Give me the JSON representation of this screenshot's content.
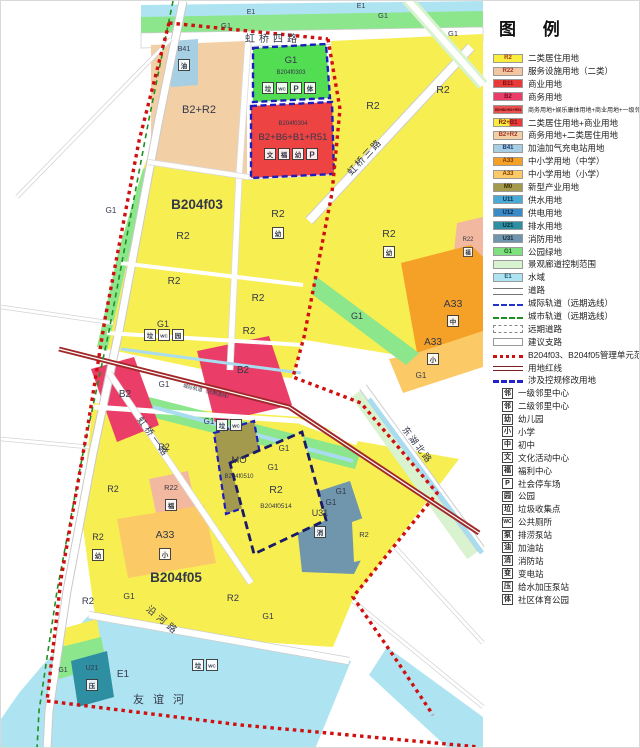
{
  "legend": {
    "title": "图  例",
    "swatches": [
      {
        "code": "R2",
        "label": "二类居住用地",
        "color": "#f9ee3e",
        "tc": "#a33325"
      },
      {
        "code": "R22",
        "label": "服务设施用地（二类）",
        "color": "#f3c6a2",
        "tc": "#a33325"
      },
      {
        "code": "B11",
        "label": "商业用地",
        "color": "#e93a3a",
        "tc": "#7a0f0f"
      },
      {
        "code": "B2",
        "label": "商务用地",
        "color": "#ea3e68",
        "tc": "#6e0f2a"
      },
      {
        "code": "B2+B6+B1+R51",
        "label": "商务用地+娱乐康体用地+商业用地+一级邻里中心用地",
        "color": "#e95050",
        "tc": "#5e0a0a",
        "small": true,
        "small_label": true
      },
      {
        "code": "R2+B1",
        "label": "二类居住用地+商业用地",
        "color": "#f9ee3e",
        "color2": "#e93a3a",
        "tc": "#7a0f0f"
      },
      {
        "code": "B2+R2",
        "label": "商务用地+二类居住用地",
        "color": "#f3cfa6",
        "tc": "#a33325"
      },
      {
        "code": "B41",
        "label": "加油加气充电站用地",
        "color": "#a6cfe3",
        "tc": "#1a3a74"
      },
      {
        "code": "A33",
        "label": "中小学用地（中学）",
        "color": "#f5a027",
        "tc": "#7a3a00"
      },
      {
        "code": "A33",
        "label": "中小学用地（小学）",
        "color": "#fbc966",
        "tc": "#7a3a00"
      },
      {
        "code": "M0",
        "label": "新型产业用地",
        "color": "#a39a4e",
        "tc": "#3a3000"
      },
      {
        "code": "U11",
        "label": "供水用地",
        "color": "#4aaad6",
        "tc": "#0a2a4a"
      },
      {
        "code": "U12",
        "label": "供电用地",
        "color": "#3a8ac8",
        "tc": "#0a2a4a"
      },
      {
        "code": "U21",
        "label": "排水用地",
        "color": "#2e8fa3",
        "tc": "#062c38"
      },
      {
        "code": "U31",
        "label": "消防用地",
        "color": "#7096ad",
        "tc": "#14283a"
      },
      {
        "code": "G1",
        "label": "公园绿地",
        "color": "#7ee07e",
        "tc": "#14591c"
      },
      {
        "code": "",
        "label": "景观廊道控制范围",
        "color": "#d9f2cf",
        "tc": "#333"
      },
      {
        "code": "E1",
        "label": "水域",
        "color": "#aee4f2",
        "tc": "#1c5a74"
      }
    ],
    "lines": [
      {
        "style": "road",
        "label": "道路"
      },
      {
        "style": "rail-blue",
        "label": "城际轨道（远期选线）"
      },
      {
        "style": "rail-green",
        "label": "城市轨道（远期选线）"
      },
      {
        "style": "road-future",
        "label": "远期道路"
      },
      {
        "style": "road-suggest",
        "label": "建议支路"
      },
      {
        "style": "unit-red",
        "label": "B204f03、B204f05管理单元范围"
      },
      {
        "style": "redline",
        "label": "用地红线"
      },
      {
        "style": "mod-blue",
        "label": "涉及控规修改用地"
      }
    ],
    "icons": [
      {
        "glyph": "邻",
        "label": "一级邻里中心"
      },
      {
        "glyph": "邻",
        "label": "二级邻里中心"
      },
      {
        "glyph": "幼",
        "label": "幼儿园"
      },
      {
        "glyph": "小",
        "label": "小学"
      },
      {
        "glyph": "中",
        "label": "初中"
      },
      {
        "glyph": "文",
        "label": "文化活动中心"
      },
      {
        "glyph": "福",
        "label": "福利中心"
      },
      {
        "glyph": "P",
        "label": "社会停车场"
      },
      {
        "glyph": "园",
        "label": "公园"
      },
      {
        "glyph": "垃",
        "label": "垃圾收集点"
      },
      {
        "glyph": "WC",
        "label": "公共厕所",
        "wc": true
      },
      {
        "glyph": "泵",
        "label": "排涝泵站"
      },
      {
        "glyph": "油",
        "label": "加油站"
      },
      {
        "glyph": "消",
        "label": "消防站"
      },
      {
        "glyph": "变",
        "label": "变电站"
      },
      {
        "glyph": "压",
        "label": "给水加压泵站"
      },
      {
        "glyph": "体",
        "label": "社区体育公园"
      }
    ]
  },
  "map": {
    "unit_north": "B204f03",
    "unit_south": "B204f05",
    "roads": {
      "hongqiao4": "虹桥四路",
      "hongqiao3": "虹桥三路",
      "hongqiao1": "虹桥一路",
      "donghu_north": "东湖北路",
      "yanhe": "沿河路"
    },
    "rail_label": "城际轨道（远期选线）",
    "river": "友谊河",
    "codes": {
      "r2": "R2",
      "g1": "G1",
      "e1": "E1",
      "b2": "B2",
      "b41": "B41",
      "a33": "A33",
      "mo": "MO",
      "u21": "U21",
      "u31": "U31",
      "r22": "R22",
      "b2r2": "B2+R2",
      "mix": "B2+B6+B1+R51"
    },
    "parcels": {
      "park": "B204f0303",
      "mixed": "B204f0304",
      "mo": "B204f0510",
      "r2": "B204f0514"
    },
    "markers": {
      "kindergarten": "幼",
      "primary": "小",
      "middle": "中",
      "fire": "消",
      "welfare": "福",
      "trash": "垃",
      "wc": "WC",
      "parking": "P",
      "sports": "体",
      "culture": "文",
      "park": "园",
      "gas": "油",
      "pump": "压"
    }
  }
}
